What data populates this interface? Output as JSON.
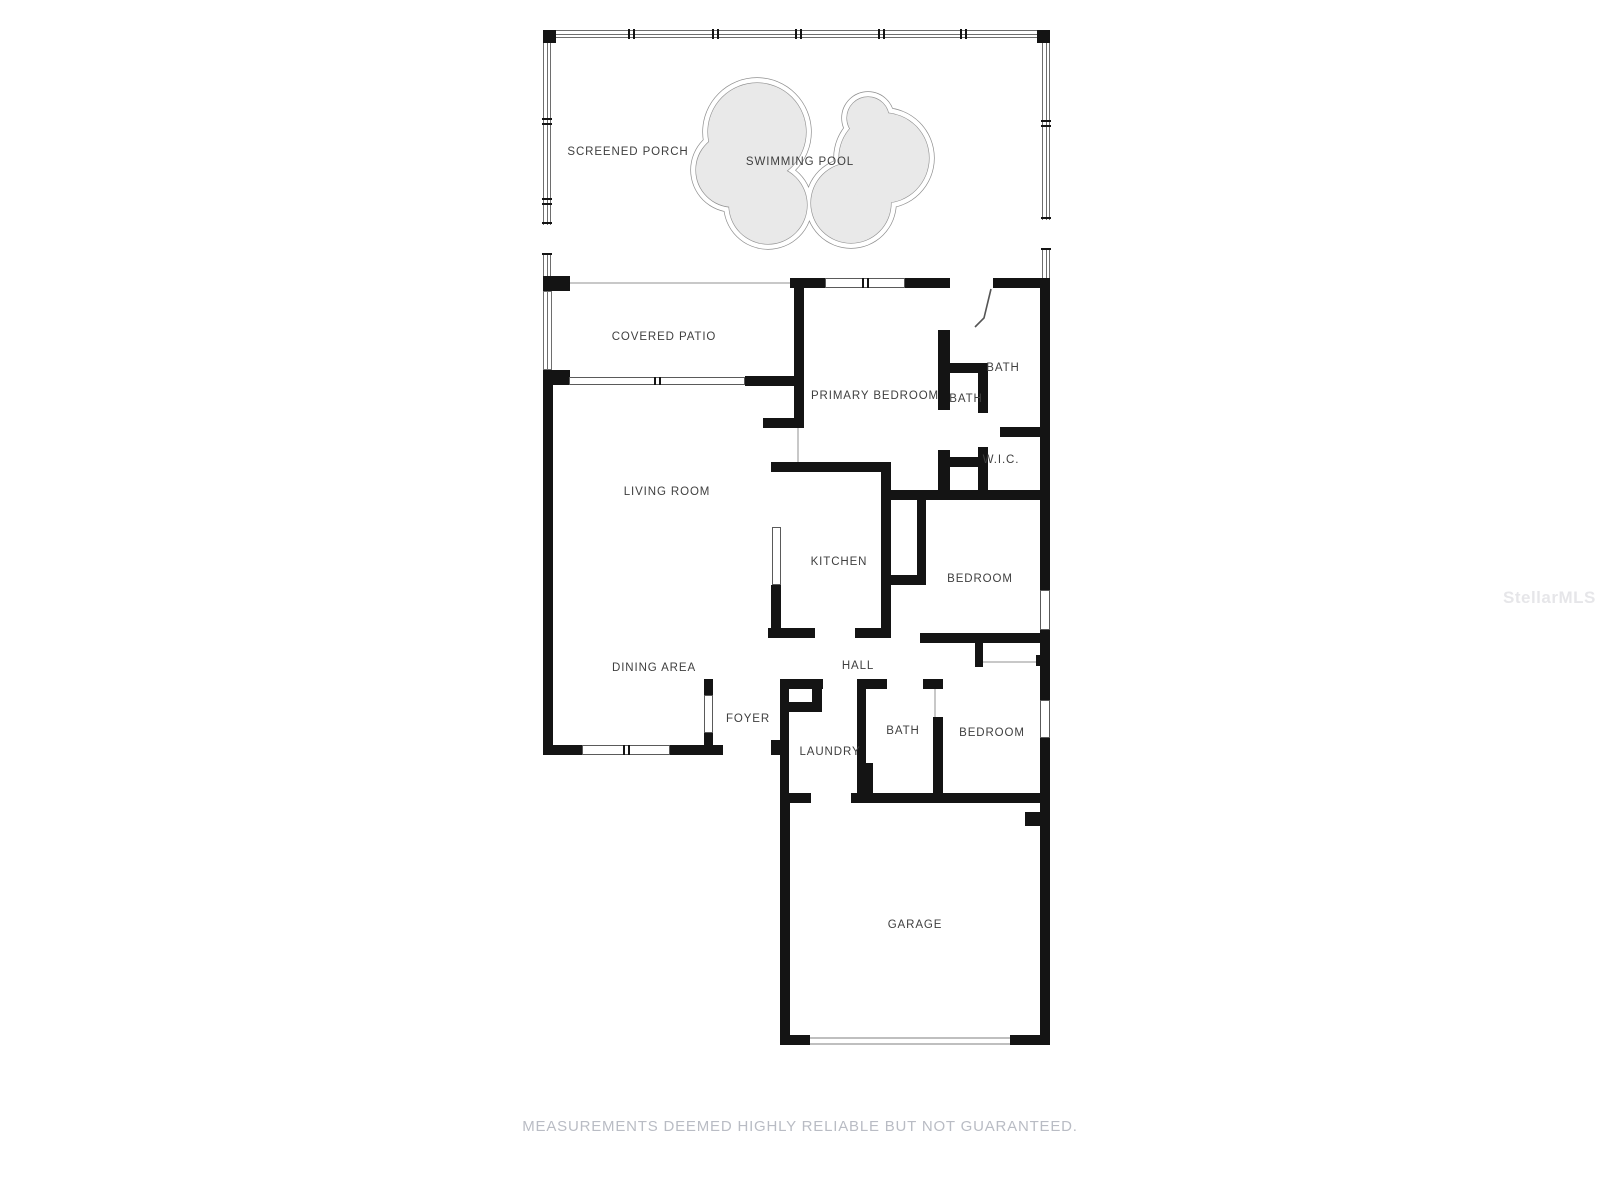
{
  "floorplan": {
    "title": "Residential floor plan",
    "rooms": [
      {
        "id": "screened-porch",
        "label": "SCREENED PORCH"
      },
      {
        "id": "swimming-pool",
        "label": "SWIMMING POOL"
      },
      {
        "id": "covered-patio",
        "label": "COVERED PATIO"
      },
      {
        "id": "primary-bedroom",
        "label": "PRIMARY BEDROOM"
      },
      {
        "id": "bath-pool",
        "label": "BATH"
      },
      {
        "id": "bath-primary",
        "label": "BATH"
      },
      {
        "id": "wic",
        "label": "W.I.C."
      },
      {
        "id": "living-room",
        "label": "LIVING ROOM"
      },
      {
        "id": "kitchen",
        "label": "KITCHEN"
      },
      {
        "id": "bedroom-middle",
        "label": "BEDROOM"
      },
      {
        "id": "dining-area",
        "label": "DINING AREA"
      },
      {
        "id": "hall",
        "label": "HALL"
      },
      {
        "id": "foyer",
        "label": "FOYER"
      },
      {
        "id": "laundry",
        "label": "LAUNDRY"
      },
      {
        "id": "bath-hall",
        "label": "BATH"
      },
      {
        "id": "bedroom-lower",
        "label": "BEDROOM"
      },
      {
        "id": "garage",
        "label": "GARAGE"
      }
    ],
    "disclaimer": "MEASUREMENTS DEEMED HIGHLY RELIABLE BUT NOT GUARANTEED.",
    "watermark": "StellarMLS",
    "colors": {
      "wall": "#141414",
      "pool_fill": "#e9e9e9",
      "pool_outline": "#8f8f8f",
      "label_text": "#3f3f3f",
      "disclaimer_text": "#b9bcc4",
      "background": "#ffffff"
    }
  }
}
